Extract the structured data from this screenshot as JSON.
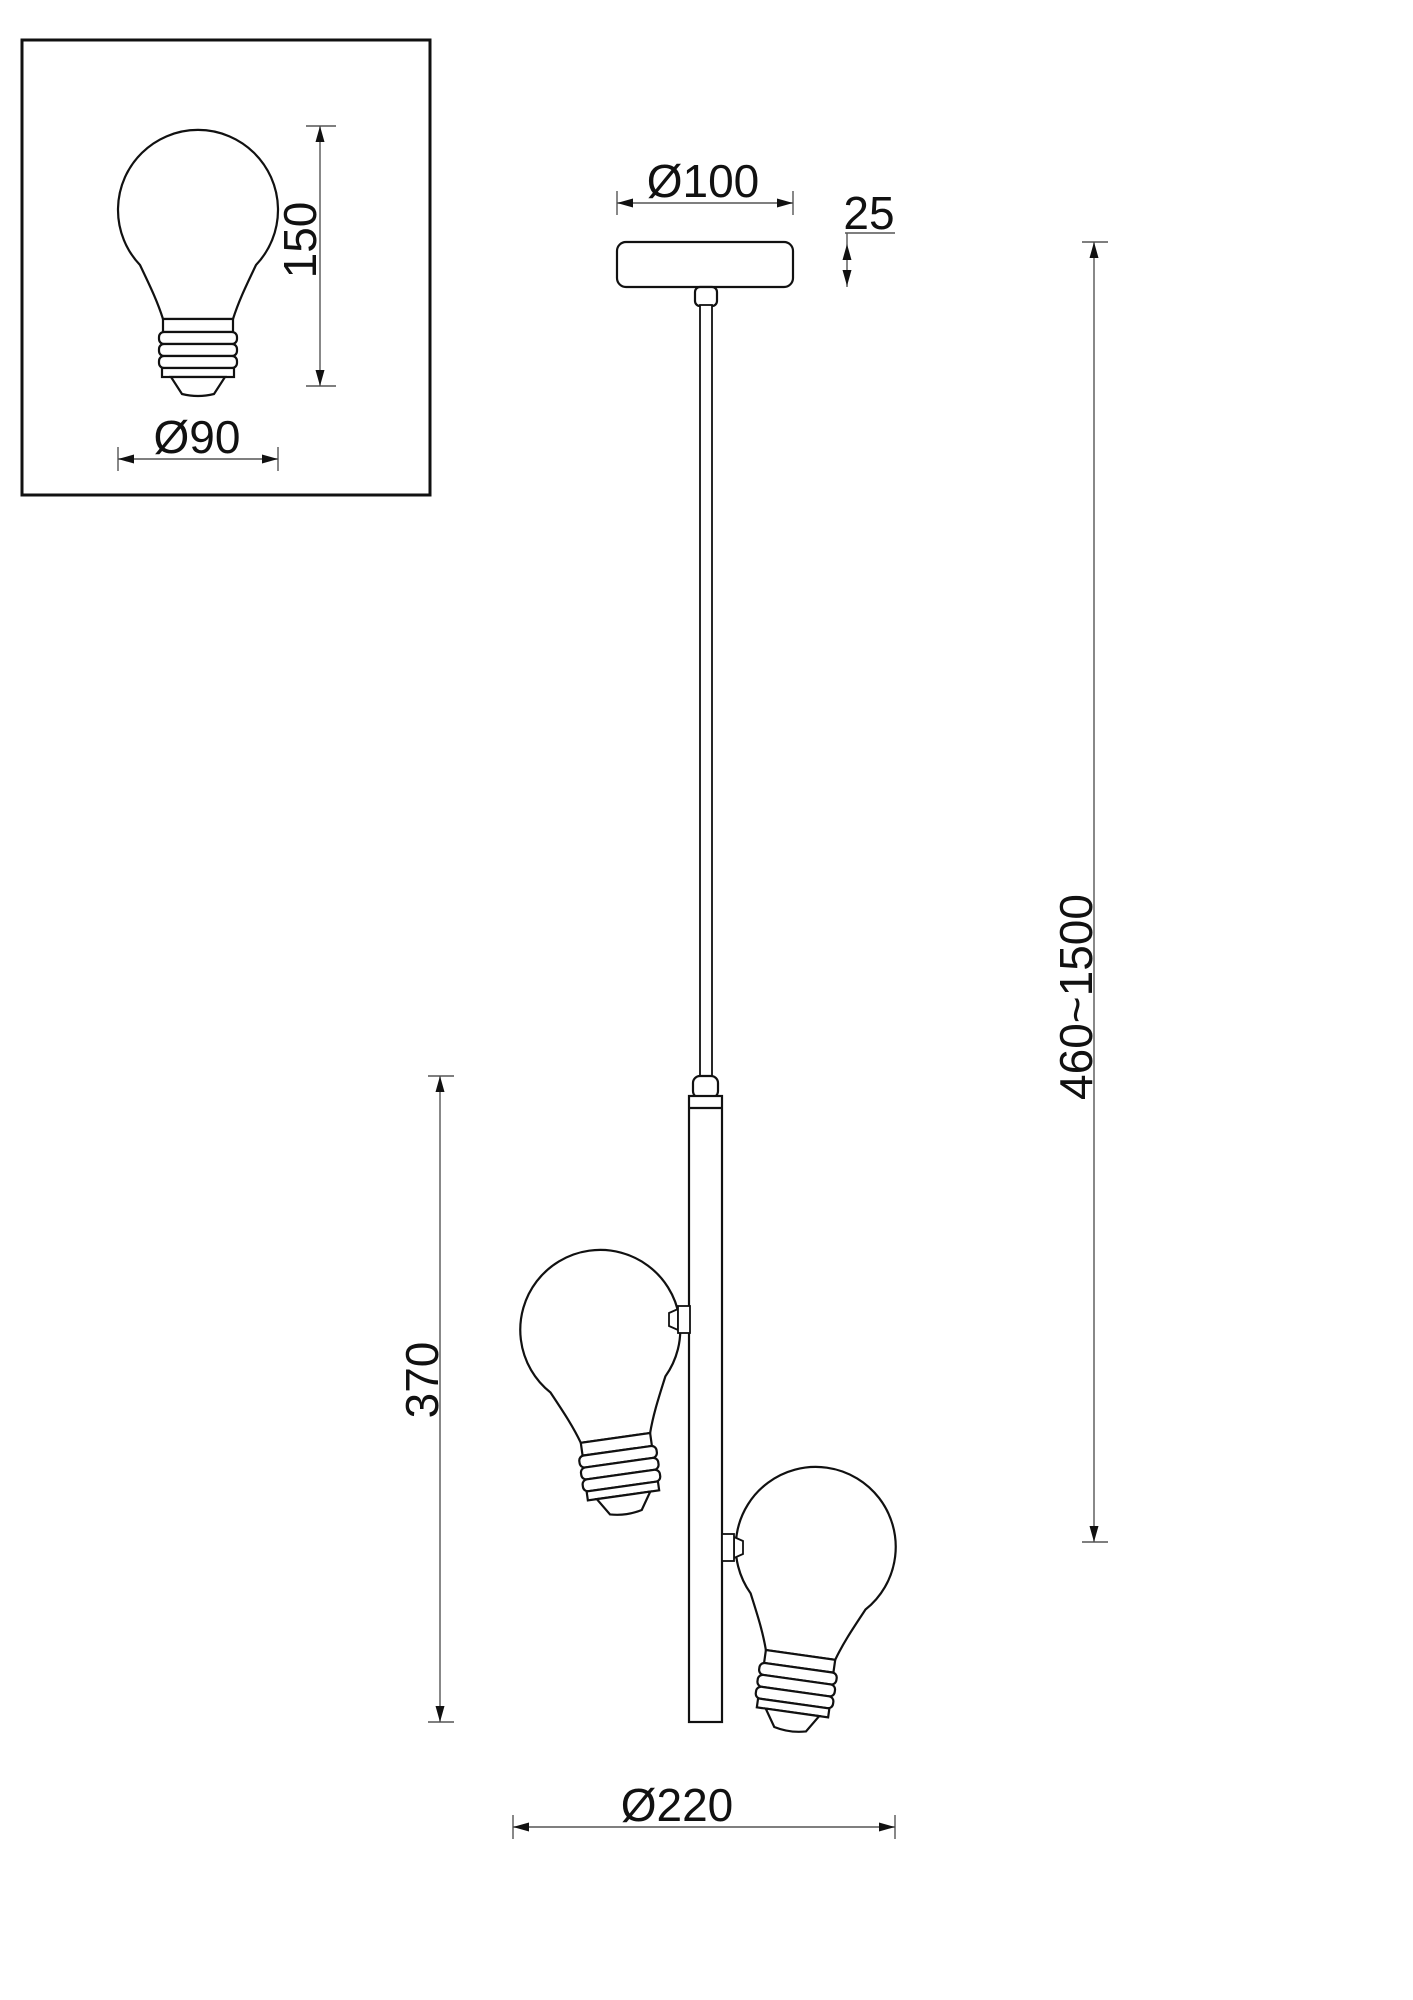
{
  "diagram": {
    "kind": "pendant-lamp dimension drawing",
    "colors": {
      "ink": "#111111",
      "dim_line": "#555555",
      "background": "#ffffff"
    },
    "inset": {
      "height_label": "150",
      "diameter_label": "Ø90"
    },
    "canopy": {
      "diameter_label": "Ø100",
      "height_label": "25"
    },
    "suspension": {
      "range_label": "460~1500"
    },
    "bar": {
      "height_label": "370"
    },
    "overall": {
      "diameter_label": "Ø220"
    },
    "dimensions": [
      {
        "value": "150",
        "applies_to": "bulb height (detail inset)"
      },
      {
        "value": "Ø90",
        "applies_to": "bulb diameter (detail inset)"
      },
      {
        "value": "Ø100",
        "applies_to": "ceiling canopy diameter"
      },
      {
        "value": "25",
        "applies_to": "ceiling canopy height"
      },
      {
        "value": "460~1500",
        "applies_to": "adjustable suspension height"
      },
      {
        "value": "370",
        "applies_to": "lamp bar length"
      },
      {
        "value": "Ø220",
        "applies_to": "overall fixture diameter"
      }
    ]
  }
}
